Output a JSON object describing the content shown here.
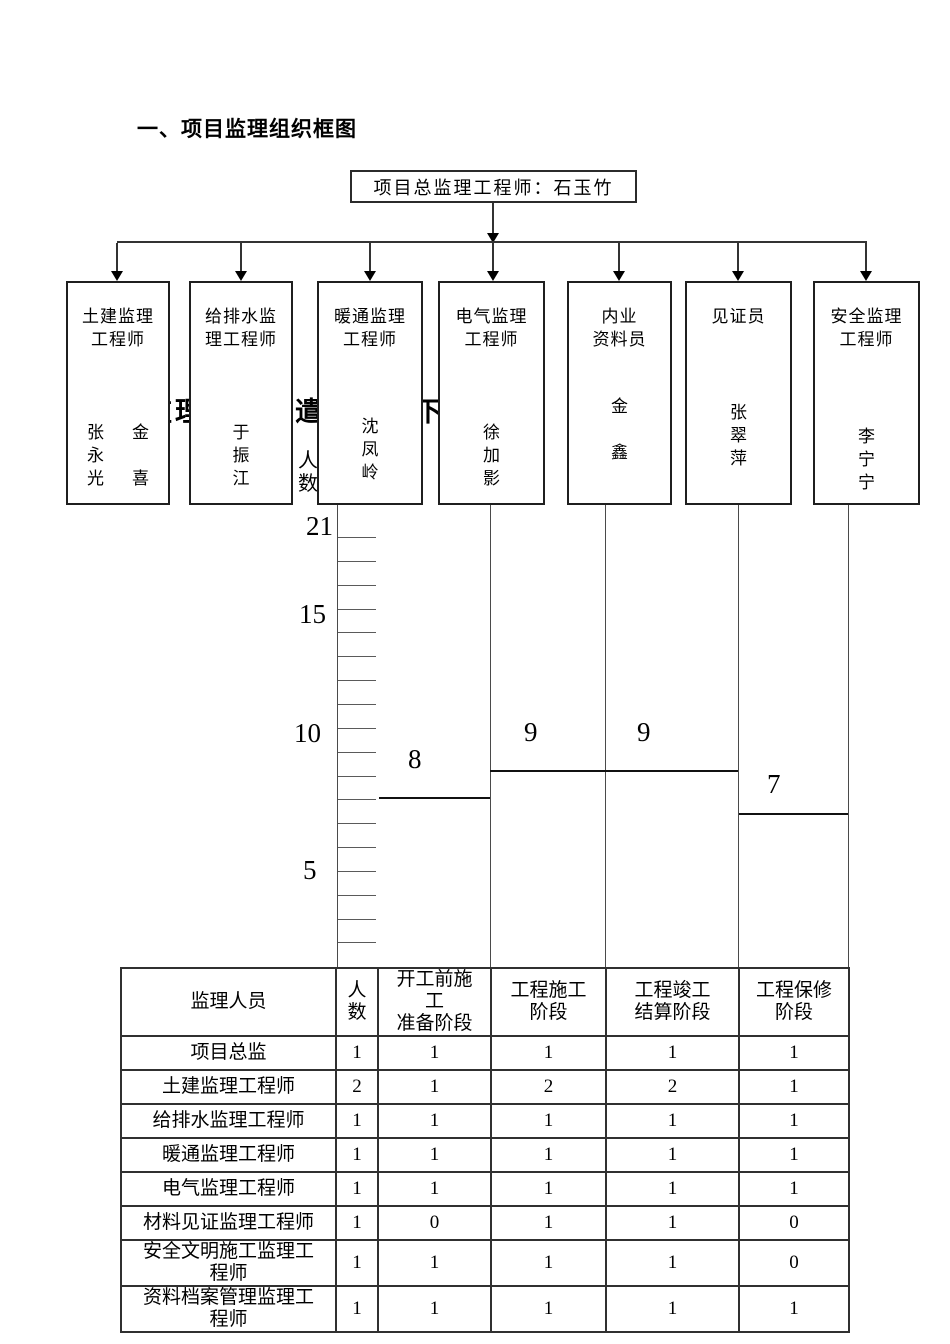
{
  "page": {
    "title": "一、项目监理组织框图"
  },
  "colors": {
    "ink": "#000000",
    "line": "#333333",
    "background": "#ffffff"
  },
  "org_chart": {
    "root_label": "项目总监理工程师：石玉竹",
    "boxes": [
      {
        "title": "土建监理\n工程师",
        "names": [
          "张\n永\n光",
          "金\n\n喜"
        ]
      },
      {
        "title": "给排水监\n理工程师",
        "names": [
          "于\n振\n江"
        ]
      },
      {
        "title": "暖通监理\n工程师",
        "names": [
          "沈\n凤\n岭"
        ]
      },
      {
        "title": "电气监理\n工程师",
        "names": [
          "徐\n加\n影"
        ]
      },
      {
        "title": "内业\n资料员",
        "names": [
          "金\n\n鑫"
        ]
      },
      {
        "title": "见证员",
        "names": [
          "张\n翠\n萍"
        ]
      },
      {
        "title": "安全监理\n工程师",
        "names": [
          "李\n宁\n宁"
        ]
      }
    ]
  },
  "obscured": {
    "heading": "监理人员派遣计划如下",
    "axis_label": "人\n数"
  },
  "chart_data": {
    "type": "bar",
    "bar_style": "top-line-only",
    "title": "",
    "xlabel": "",
    "ylabel": "人数",
    "categories": [
      "开工前施工准备阶段",
      "工程施工阶段",
      "工程竣工结算阶段",
      "工程保修阶段"
    ],
    "values": [
      8,
      9,
      9,
      7
    ],
    "yticks": [
      21,
      15,
      10,
      5
    ],
    "ylim": [
      0,
      22
    ],
    "grid": false,
    "legend": "none"
  },
  "table": {
    "headers": [
      "监理人员",
      "人\n数",
      "开工前施\n工\n准备阶段",
      "工程施工\n阶段",
      "工程竣工\n结算阶段",
      "工程保修\n阶段"
    ],
    "rows": [
      {
        "label": "项目总监",
        "values": [
          "1",
          "1",
          "1",
          "1",
          "1"
        ]
      },
      {
        "label": "土建监理工程师",
        "values": [
          "2",
          "1",
          "2",
          "2",
          "1"
        ]
      },
      {
        "label": "给排水监理工程师",
        "values": [
          "1",
          "1",
          "1",
          "1",
          "1"
        ]
      },
      {
        "label": "暖通监理工程师",
        "values": [
          "1",
          "1",
          "1",
          "1",
          "1"
        ]
      },
      {
        "label": "电气监理工程师",
        "values": [
          "1",
          "1",
          "1",
          "1",
          "1"
        ]
      },
      {
        "label": "材料见证监理工程师",
        "values": [
          "1",
          "0",
          "1",
          "1",
          "0"
        ]
      },
      {
        "label": "安全文明施工监理工\n程师",
        "values": [
          "1",
          "1",
          "1",
          "1",
          "0"
        ]
      },
      {
        "label": "资料档案管理监理工\n程师",
        "values": [
          "1",
          "1",
          "1",
          "1",
          "1"
        ]
      }
    ]
  }
}
